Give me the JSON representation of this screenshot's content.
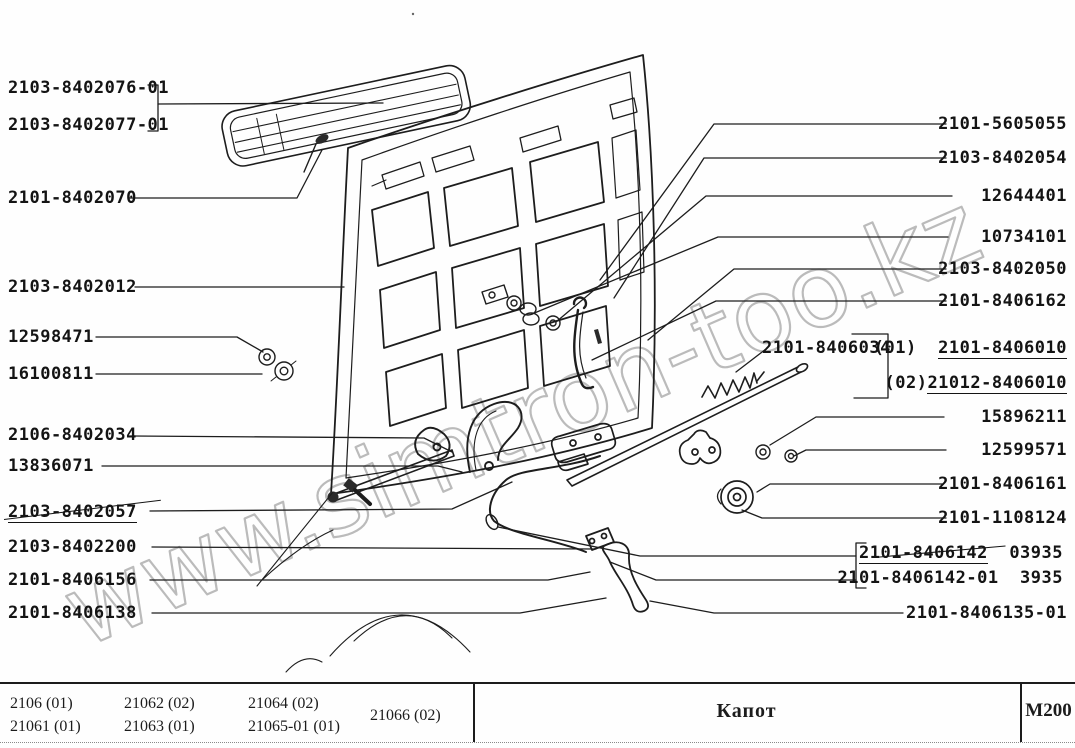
{
  "watermark": "www.simtron-too.kz",
  "labels": {
    "left": [
      "2103-8402076-01",
      "2103-8402077-01",
      "2101-8402070",
      "2103-8402012",
      "12598471",
      "16100811",
      "2106-8402034",
      "13836071",
      "2103-8402057",
      "2103-8402200",
      "2101-8406156",
      "2101-8406138"
    ],
    "right": [
      "2101-5605055",
      "2103-8402054",
      "12644401",
      "10734101",
      "2103-8402050",
      "2101-8406162",
      "15896211",
      "12599571",
      "2101-8406161",
      "2101-1108124",
      "2101-8406135-01"
    ]
  },
  "lock_variants": {
    "base": "2101-8406034",
    "v1_prefix": "(01)",
    "v1_part": "2101-8406010",
    "v2_prefix": "(02)",
    "v2_part": "21012-8406010"
  },
  "cable_variants": {
    "line1_part": "2101-8406142",
    "line1_code": "03935",
    "line2_part": "2101-8406142-01",
    "line2_code": "3935"
  },
  "footer": {
    "models": [
      [
        "2106 (01)",
        "21061 (01)"
      ],
      [
        "21062 (02)",
        "21063 (01)"
      ],
      [
        "21064 (02)",
        "21065-01 (01)"
      ],
      [
        "21066 (02)"
      ]
    ],
    "title": "Капот",
    "code": "М200"
  }
}
